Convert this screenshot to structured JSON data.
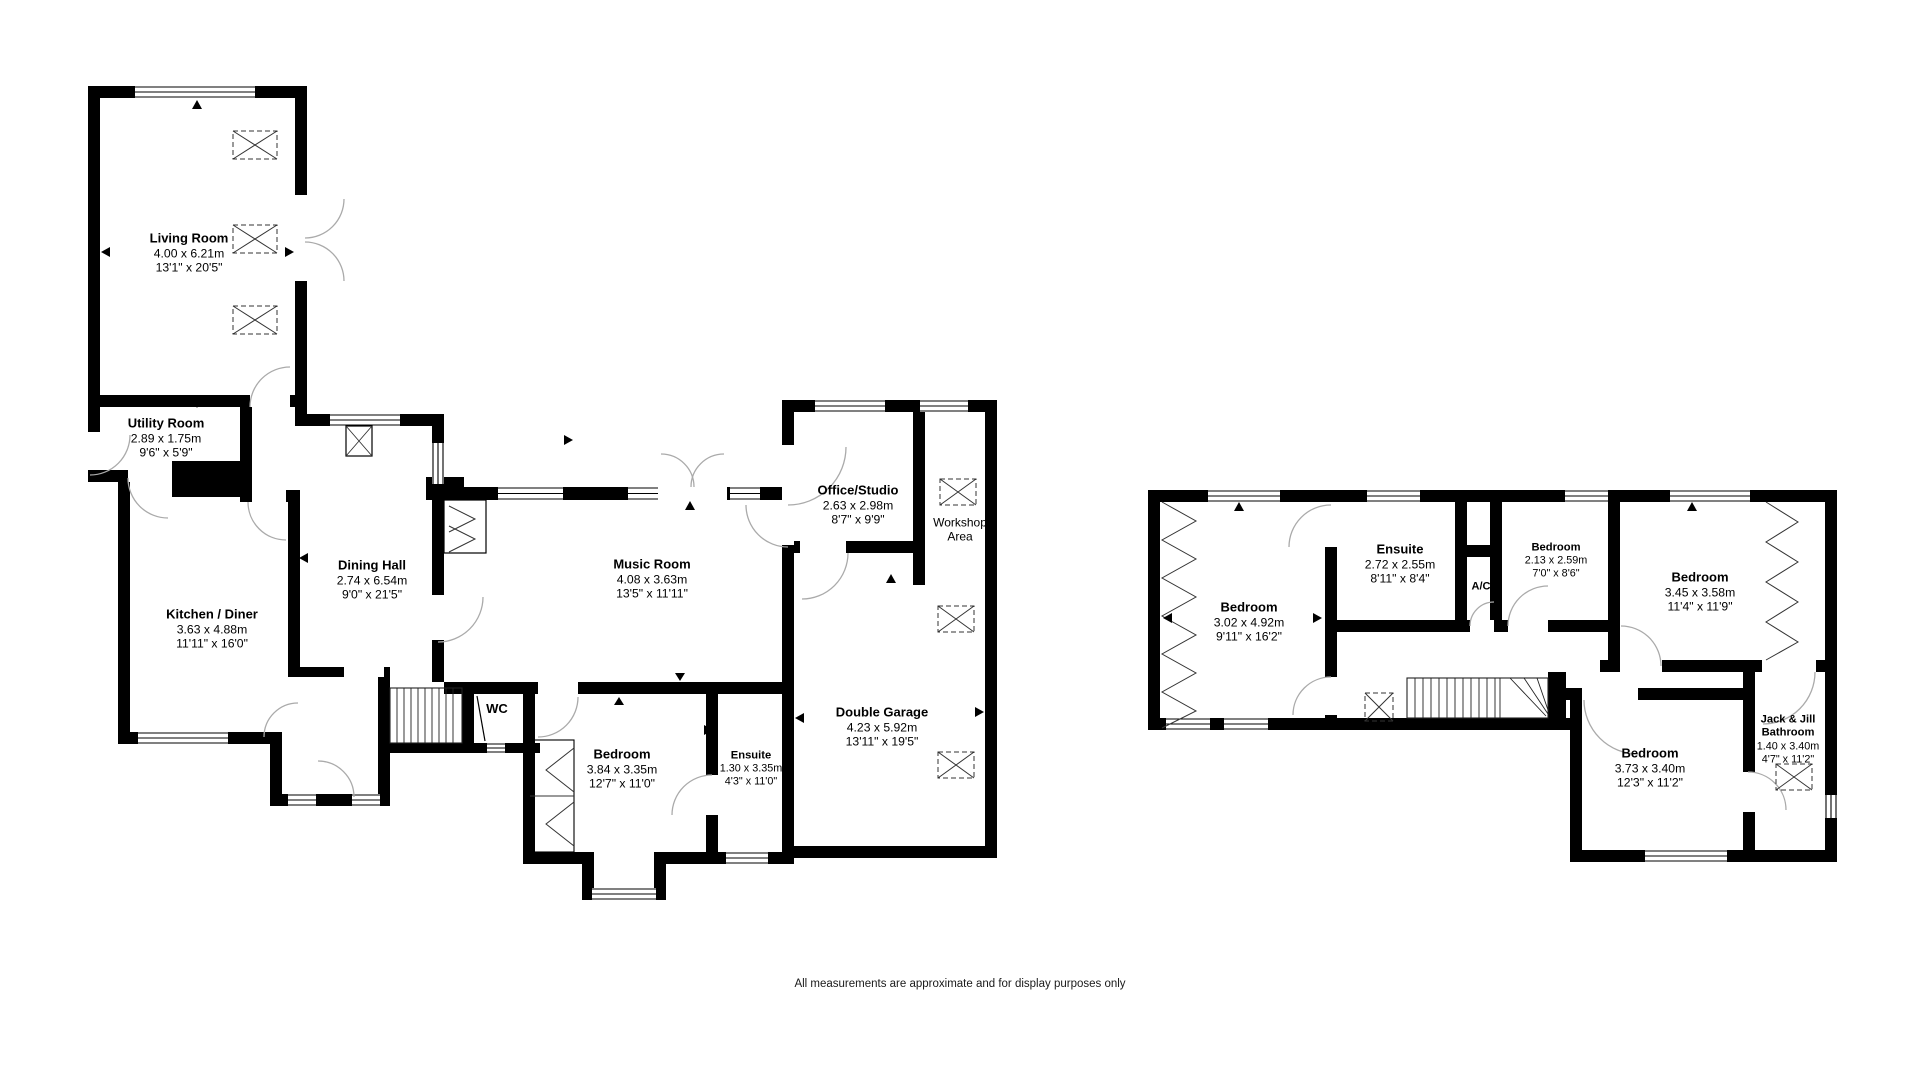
{
  "page": {
    "background": "#ffffff",
    "wall_color": "#000000",
    "door_arc_color": "#aaaaaa"
  },
  "footer": {
    "disclaimer": "All measurements are approximate and for display purposes only"
  },
  "rooms": [
    {
      "id": "living-room",
      "floor": "ground",
      "name": "Living Room",
      "metric": "4.00 x 6.21m",
      "imperial": "13'1\" x 20'5\""
    },
    {
      "id": "utility-room",
      "floor": "ground",
      "name": "Utility Room",
      "metric": "2.89 x 1.75m",
      "imperial": "9'6\" x 5'9\""
    },
    {
      "id": "kitchen-diner",
      "floor": "ground",
      "name": "Kitchen / Diner",
      "metric": "3.63 x 4.88m",
      "imperial": "11'11\" x 16'0\""
    },
    {
      "id": "dining-hall",
      "floor": "ground",
      "name": "Dining Hall",
      "metric": "2.74 x 6.54m",
      "imperial": "9'0\" x 21'5\""
    },
    {
      "id": "music-room",
      "floor": "ground",
      "name": "Music Room",
      "metric": "4.08 x 3.63m",
      "imperial": "13'5\" x 11'11\""
    },
    {
      "id": "office-studio",
      "floor": "ground",
      "name": "Office/Studio",
      "metric": "2.63 x 2.98m",
      "imperial": "8'7\" x 9'9\""
    },
    {
      "id": "workshop-area",
      "floor": "ground",
      "name": "Workshop Area"
    },
    {
      "id": "double-garage",
      "floor": "ground",
      "name": "Double Garage",
      "metric": "4.23 x 5.92m",
      "imperial": "13'11\" x 19'5\""
    },
    {
      "id": "wc",
      "floor": "ground",
      "name": "WC"
    },
    {
      "id": "bedroom-ground",
      "floor": "ground",
      "name": "Bedroom",
      "metric": "3.84 x 3.35m",
      "imperial": "12'7\" x 11'0\""
    },
    {
      "id": "ensuite-ground",
      "floor": "ground",
      "name": "Ensuite",
      "metric": "1.30 x 3.35m",
      "imperial": "4'3\" x 11'0\""
    },
    {
      "id": "bedroom-first-left",
      "floor": "first",
      "name": "Bedroom",
      "metric": "3.02 x 4.92m",
      "imperial": "9'11\" x 16'2\""
    },
    {
      "id": "ensuite-first",
      "floor": "first",
      "name": "Ensuite",
      "metric": "2.72 x 2.55m",
      "imperial": "8'11\" x 8'4\""
    },
    {
      "id": "bedroom-first-small",
      "floor": "first",
      "name": "Bedroom",
      "metric": "2.13 x 2.59m",
      "imperial": "7'0\" x 8'6\""
    },
    {
      "id": "ac-cupboard",
      "floor": "first",
      "name": "A/C"
    },
    {
      "id": "bedroom-first-right",
      "floor": "first",
      "name": "Bedroom",
      "metric": "3.45 x 3.58m",
      "imperial": "11'4\" x 11'9\""
    },
    {
      "id": "bedroom-first-bottom",
      "floor": "first",
      "name": "Bedroom",
      "metric": "3.73 x 3.40m",
      "imperial": "12'3\" x 11'2\""
    },
    {
      "id": "jack-and-jill-bathroom",
      "floor": "first",
      "name": "Jack & Jill Bathroom",
      "metric": "1.40 x 3.40m",
      "imperial": "4'7\" x 11'2\""
    }
  ]
}
